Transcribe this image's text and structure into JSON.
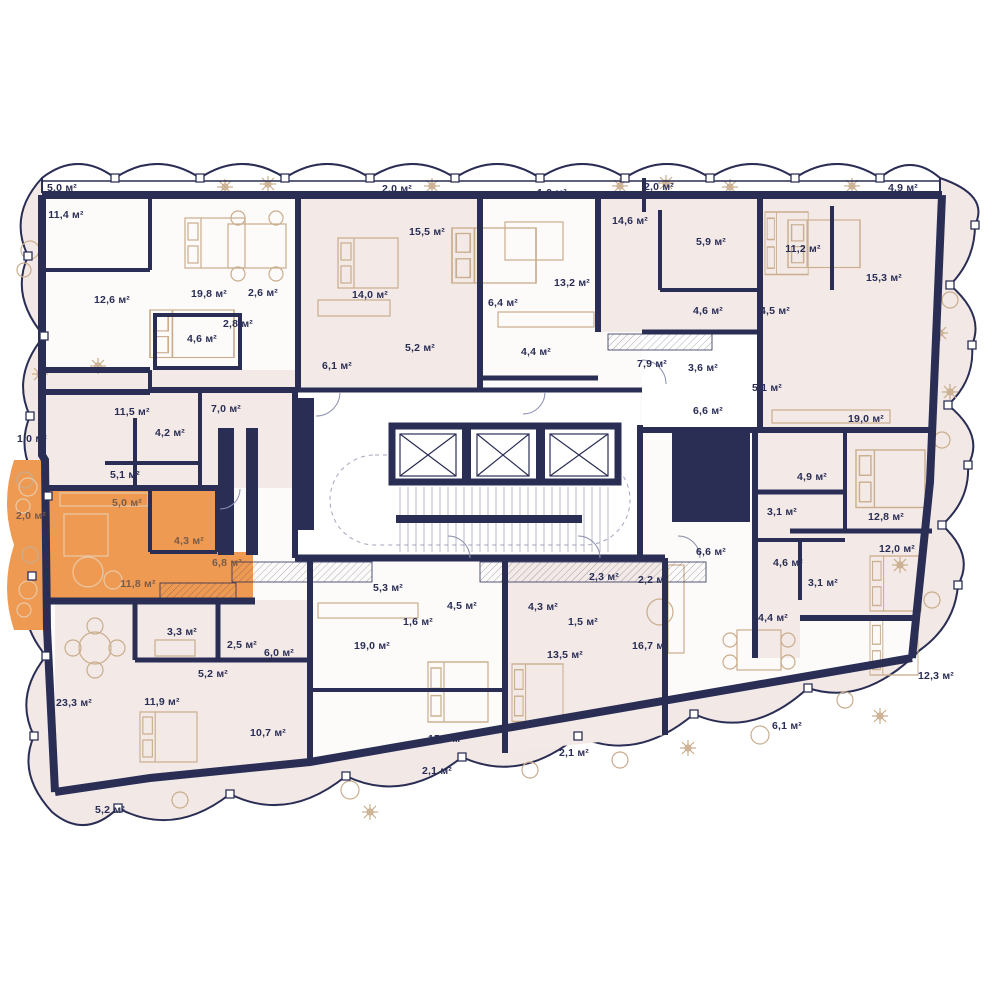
{
  "plan": {
    "title": "Residential floor plan",
    "units_suffix": "м²",
    "colors": {
      "wall": "#2A2E55",
      "band_fill": "#F2E8E5",
      "unit_pink": "#F3E9E6",
      "unit_white": "#FDFBFA",
      "highlight": "#EF9A52",
      "furniture": "#C9AD8D"
    },
    "highlighted_unit": {
      "name": "selected apartment",
      "color": "#EF9A52",
      "room_areas": [
        "2,0",
        "5,0",
        "4,3",
        "6,8",
        "11,8"
      ]
    },
    "rooms": [
      {
        "area": "5,0",
        "x": 62,
        "y": 188
      },
      {
        "area": "11,4",
        "x": 66,
        "y": 215
      },
      {
        "area": "2,0",
        "x": 397,
        "y": 189
      },
      {
        "area": "1,0",
        "x": 552,
        "y": 193
      },
      {
        "area": "2,0",
        "x": 659,
        "y": 187
      },
      {
        "area": "4,9",
        "x": 903,
        "y": 188
      },
      {
        "area": "15,5",
        "x": 427,
        "y": 232
      },
      {
        "area": "14,6",
        "x": 630,
        "y": 221
      },
      {
        "area": "5,9",
        "x": 711,
        "y": 242
      },
      {
        "area": "11,2",
        "x": 803,
        "y": 249
      },
      {
        "area": "15,3",
        "x": 884,
        "y": 278
      },
      {
        "area": "13,2",
        "x": 572,
        "y": 283
      },
      {
        "area": "12,6",
        "x": 112,
        "y": 300
      },
      {
        "area": "19,8",
        "x": 209,
        "y": 294
      },
      {
        "area": "2,6",
        "x": 263,
        "y": 293
      },
      {
        "area": "14,0",
        "x": 370,
        "y": 295
      },
      {
        "area": "6,4",
        "x": 503,
        "y": 303
      },
      {
        "area": "2,8",
        "x": 238,
        "y": 324
      },
      {
        "area": "4,6",
        "x": 202,
        "y": 339
      },
      {
        "area": "4,6",
        "x": 708,
        "y": 311
      },
      {
        "area": "4,5",
        "x": 775,
        "y": 311
      },
      {
        "area": "5,2",
        "x": 420,
        "y": 348
      },
      {
        "area": "4,4",
        "x": 536,
        "y": 352
      },
      {
        "area": "6,1",
        "x": 337,
        "y": 366
      },
      {
        "area": "7,9",
        "x": 652,
        "y": 364
      },
      {
        "area": "3,6",
        "x": 703,
        "y": 368
      },
      {
        "area": "5,1",
        "x": 767,
        "y": 388
      },
      {
        "area": "6,6",
        "x": 708,
        "y": 411
      },
      {
        "area": "19,0",
        "x": 866,
        "y": 419
      },
      {
        "area": "11,5",
        "x": 132,
        "y": 412
      },
      {
        "area": "7,0",
        "x": 226,
        "y": 409
      },
      {
        "area": "4,2",
        "x": 170,
        "y": 433
      },
      {
        "area": "1,0",
        "x": 32,
        "y": 439
      },
      {
        "area": "5,1",
        "x": 125,
        "y": 475
      },
      {
        "area": "5,0",
        "x": 127,
        "y": 503,
        "muted": true
      },
      {
        "area": "2,0",
        "x": 31,
        "y": 516,
        "muted": true
      },
      {
        "area": "4,3",
        "x": 189,
        "y": 541,
        "muted": true
      },
      {
        "area": "6,8",
        "x": 227,
        "y": 563,
        "muted": true
      },
      {
        "area": "11,8",
        "x": 138,
        "y": 584,
        "muted": true
      },
      {
        "area": "4,9",
        "x": 812,
        "y": 477
      },
      {
        "area": "3,1",
        "x": 782,
        "y": 512
      },
      {
        "area": "12,8",
        "x": 886,
        "y": 517
      },
      {
        "area": "6,6",
        "x": 711,
        "y": 552
      },
      {
        "area": "4,6",
        "x": 788,
        "y": 563
      },
      {
        "area": "3,1",
        "x": 823,
        "y": 583
      },
      {
        "area": "12,0",
        "x": 897,
        "y": 549
      },
      {
        "area": "2,3",
        "x": 604,
        "y": 577
      },
      {
        "area": "2,2",
        "x": 653,
        "y": 580
      },
      {
        "area": "5,3",
        "x": 388,
        "y": 588
      },
      {
        "area": "4,5",
        "x": 462,
        "y": 606
      },
      {
        "area": "4,3",
        "x": 543,
        "y": 607
      },
      {
        "area": "1,6",
        "x": 418,
        "y": 622
      },
      {
        "area": "1,5",
        "x": 583,
        "y": 622
      },
      {
        "area": "19,0",
        "x": 372,
        "y": 646
      },
      {
        "area": "13,5",
        "x": 565,
        "y": 655
      },
      {
        "area": "16,7",
        "x": 650,
        "y": 646
      },
      {
        "area": "3,3",
        "x": 182,
        "y": 632
      },
      {
        "area": "2,5",
        "x": 242,
        "y": 645
      },
      {
        "area": "6,0",
        "x": 279,
        "y": 653
      },
      {
        "area": "5,2",
        "x": 213,
        "y": 674
      },
      {
        "area": "23,3",
        "x": 74,
        "y": 703
      },
      {
        "area": "11,9",
        "x": 162,
        "y": 702
      },
      {
        "area": "10,7",
        "x": 268,
        "y": 733
      },
      {
        "area": "5,2",
        "x": 110,
        "y": 810
      },
      {
        "area": "15,3",
        "x": 446,
        "y": 739
      },
      {
        "area": "2,1",
        "x": 437,
        "y": 771
      },
      {
        "area": "2,1",
        "x": 574,
        "y": 753
      },
      {
        "area": "24,4",
        "x": 770,
        "y": 618
      },
      {
        "area": "12,3",
        "x": 936,
        "y": 676
      },
      {
        "area": "6,1",
        "x": 787,
        "y": 726
      }
    ]
  }
}
